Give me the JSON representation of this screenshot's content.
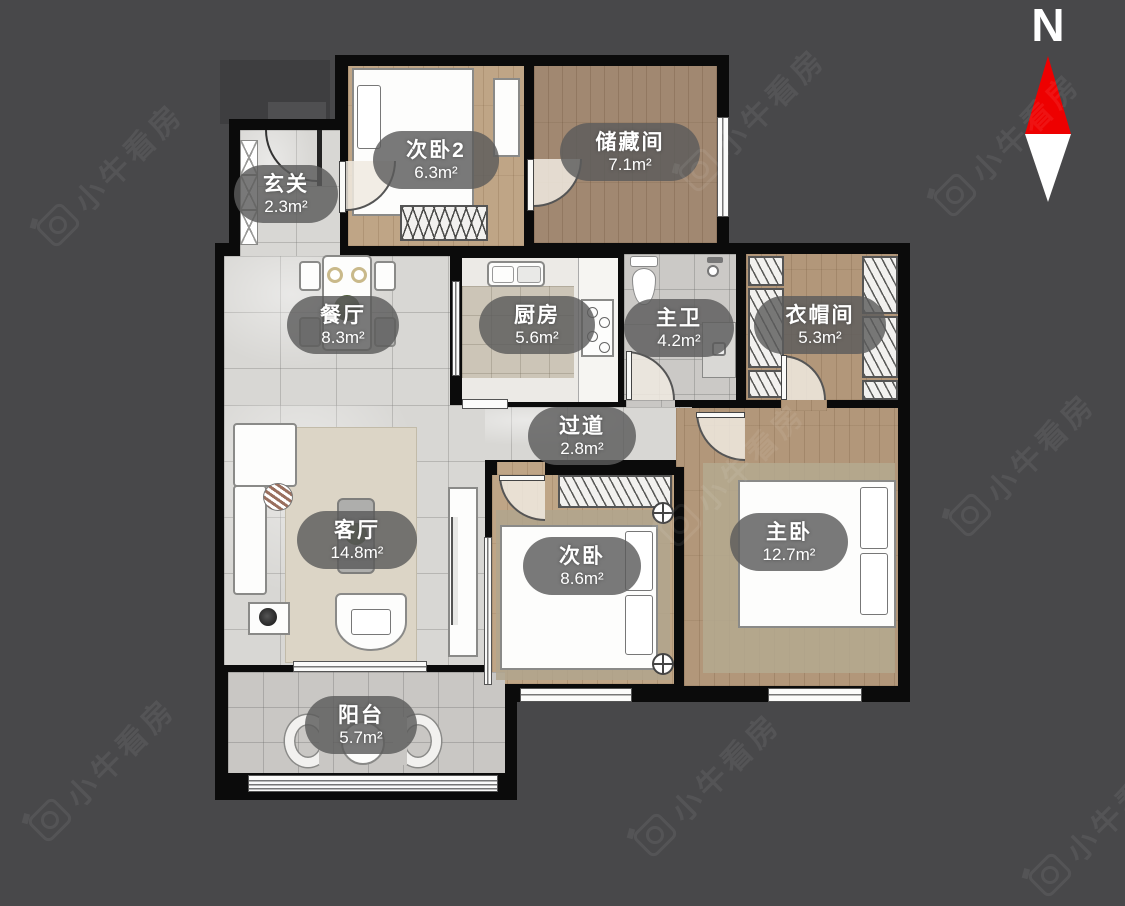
{
  "compass": {
    "north_label": "N"
  },
  "watermark": {
    "text": "小牛看房"
  },
  "rooms": [
    {
      "key": "xuanguan",
      "name": "玄关",
      "area": "2.3m²"
    },
    {
      "key": "ciwo2",
      "name": "次卧2",
      "area": "6.3m²"
    },
    {
      "key": "chucangjian",
      "name": "储藏间",
      "area": "7.1m²"
    },
    {
      "key": "canting",
      "name": "餐厅",
      "area": "8.3m²"
    },
    {
      "key": "chufang",
      "name": "厨房",
      "area": "5.6m²"
    },
    {
      "key": "zhuwei",
      "name": "主卫",
      "area": "4.2m²"
    },
    {
      "key": "yimaojian",
      "name": "衣帽间",
      "area": "5.3m²"
    },
    {
      "key": "guodao",
      "name": "过道",
      "area": "2.8m²"
    },
    {
      "key": "keting",
      "name": "客厅",
      "area": "14.8m²"
    },
    {
      "key": "ciwo",
      "name": "次卧",
      "area": "8.6m²"
    },
    {
      "key": "zhuwo",
      "name": "主卧",
      "area": "12.7m²"
    },
    {
      "key": "yangtai",
      "name": "阳台",
      "area": "5.7m²"
    }
  ],
  "colors": {
    "background": "#48484a",
    "wall": "#0b0b0b",
    "compass_red": "#ee0000",
    "compass_white": "#ffffff",
    "label_pill": "rgba(92,92,92,0.82)",
    "tile_floor": "#d8d7d4",
    "wood_floor": "#b2977a"
  }
}
